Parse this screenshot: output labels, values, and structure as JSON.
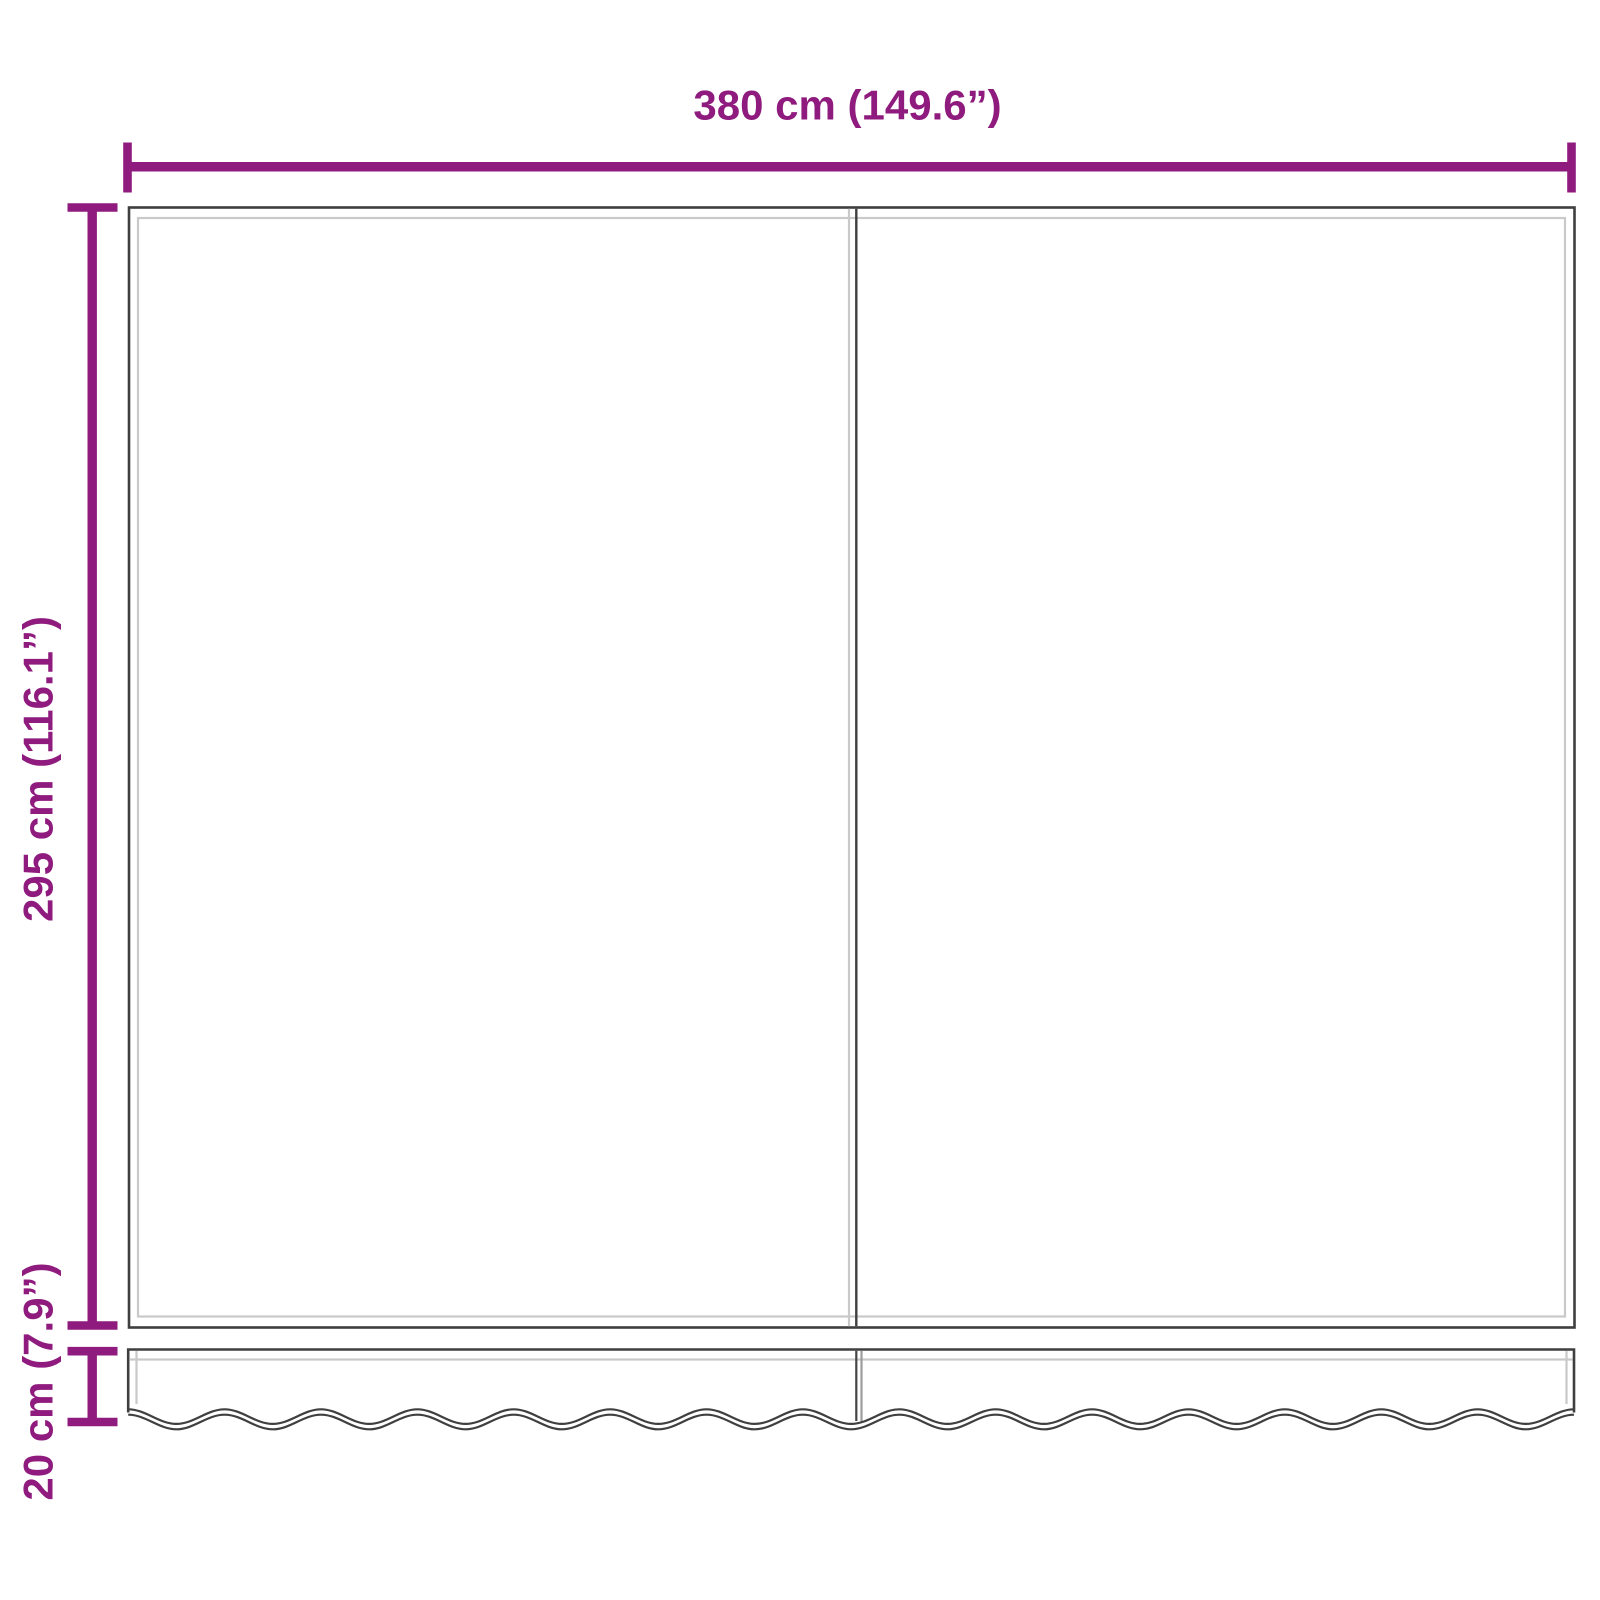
{
  "diagram": {
    "dimension_labels": {
      "width": "380 cm (149.6”)",
      "height": "295 cm (116.1”)",
      "valance_height": "20 cm (7.9”)"
    },
    "colors": {
      "dimension_accent": "#8e1b7d",
      "fabric_outline_dark": "#3f3f3f",
      "fabric_outline_light": "#c9c9c9",
      "valance_seam_light": "#9c9c9c",
      "background": "#ffffff"
    }
  }
}
